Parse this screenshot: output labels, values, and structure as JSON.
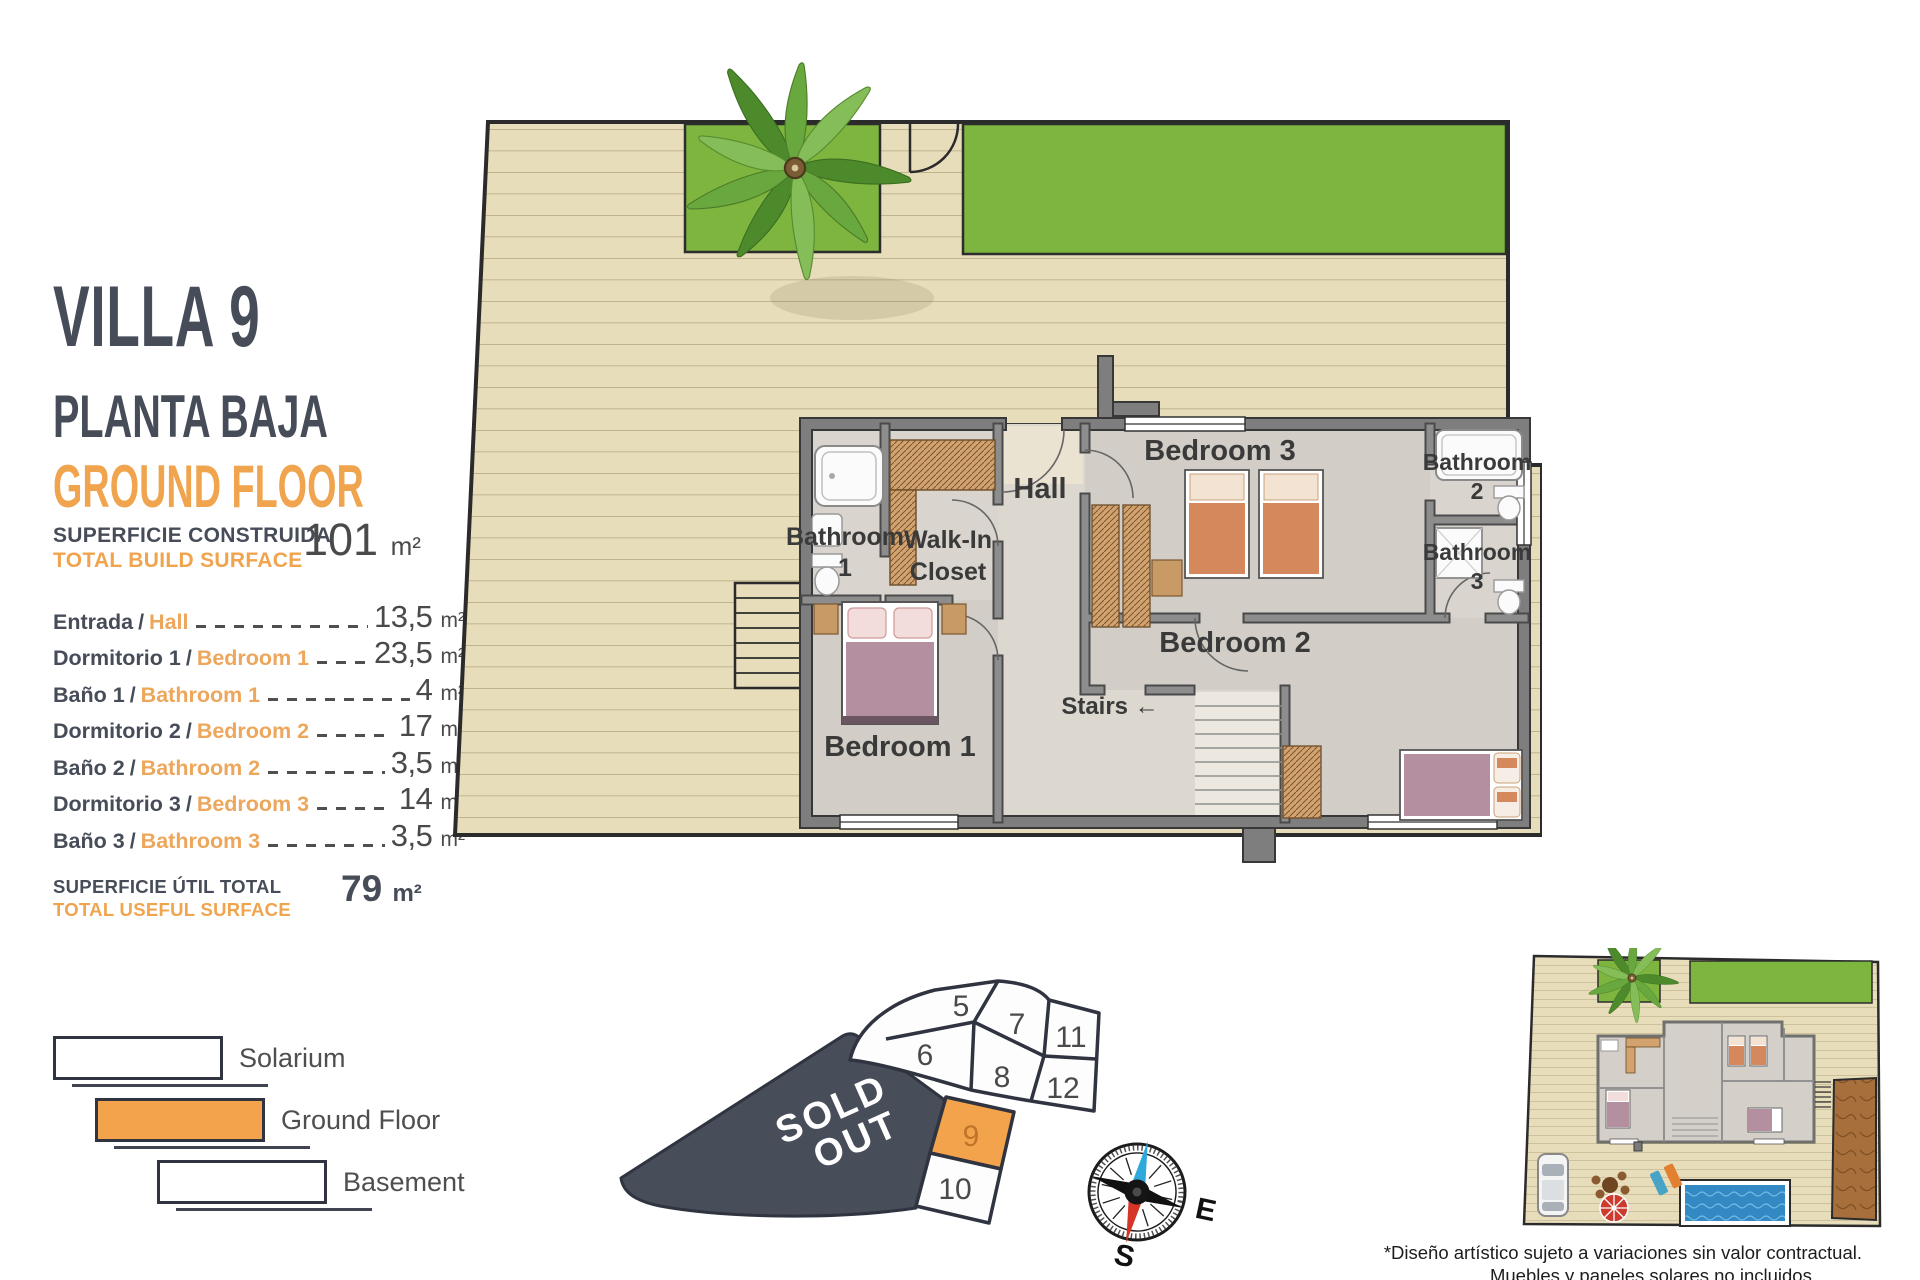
{
  "panel": {
    "title": "VILLA 9",
    "subtitle_es": "PLANTA BAJA",
    "subtitle_en": "GROUND FLOOR",
    "separator": "/",
    "build_surface": {
      "label_es": "SUPERFICIE CONSTRUIDA",
      "label_en": "TOTAL BUILD SURFACE",
      "value": "101",
      "unit": "m²"
    },
    "rooms": [
      {
        "name_es": "Entrada",
        "name_en": "Hall",
        "value": "13,5",
        "unit": "m²"
      },
      {
        "name_es": "Dormitorio 1",
        "name_en": "Bedroom 1",
        "value": "23,5",
        "unit": "m²"
      },
      {
        "name_es": "Baño 1",
        "name_en": "Bathroom 1",
        "value": "4",
        "unit": "m²"
      },
      {
        "name_es": "Dormitorio 2",
        "name_en": "Bedroom 2",
        "value": "17",
        "unit": "m²"
      },
      {
        "name_es": "Baño 2",
        "name_en": "Bathroom 2",
        "value": "3,5",
        "unit": "m²"
      },
      {
        "name_es": "Dormitorio 3",
        "name_en": "Bedroom 3",
        "value": "14",
        "unit": "m²"
      },
      {
        "name_es": "Baño 3",
        "name_en": "Bathroom 3",
        "value": "3,5",
        "unit": "m²"
      }
    ],
    "useful_surface": {
      "label_es": "SUPERFICIE ÚTIL TOTAL",
      "label_en": "TOTAL USEFUL SURFACE",
      "value": "79",
      "unit": "m²"
    },
    "legend": [
      {
        "label": "Solarium",
        "highlighted": false
      },
      {
        "label": "Ground Floor",
        "highlighted": true
      },
      {
        "label": "Basement",
        "highlighted": false
      }
    ]
  },
  "floor_plan": {
    "labels": {
      "hall": "Hall",
      "bathroom1": [
        "Bathroom",
        "1"
      ],
      "walk_in_closet": [
        "Walk-In",
        "Closet"
      ],
      "bedroom3": "Bedroom 3",
      "bathroom2": [
        "Bathroom",
        "2"
      ],
      "bathroom3": [
        "Bathroom",
        "3"
      ],
      "bedroom2": "Bedroom 2",
      "bedroom1": "Bedroom 1",
      "stairs": "Stairs ←"
    }
  },
  "plot_map": {
    "sold_out_line1": "SOLD",
    "sold_out_line2": "OUT",
    "plots": [
      {
        "number": "5",
        "highlighted": false
      },
      {
        "number": "6",
        "highlighted": false
      },
      {
        "number": "7",
        "highlighted": false
      },
      {
        "number": "8",
        "highlighted": false
      },
      {
        "number": "9",
        "highlighted": true
      },
      {
        "number": "10",
        "highlighted": false
      },
      {
        "number": "11",
        "highlighted": false
      },
      {
        "number": "12",
        "highlighted": false
      }
    ]
  },
  "compass": {
    "east": "E",
    "south": "S"
  },
  "footnote": {
    "line1": "*Diseño artístico sujeto a variaciones sin valor contractual.",
    "line2": "Muebles y paneles solares no incluidos."
  },
  "colors": {
    "accent_orange": "#f0a44e",
    "dark_slate": "#474c59",
    "deck": "#e8ddbb",
    "lawn": "#7db53f",
    "sold_out_fill": "#484d5a",
    "plot_highlight": "#f2a34c"
  }
}
